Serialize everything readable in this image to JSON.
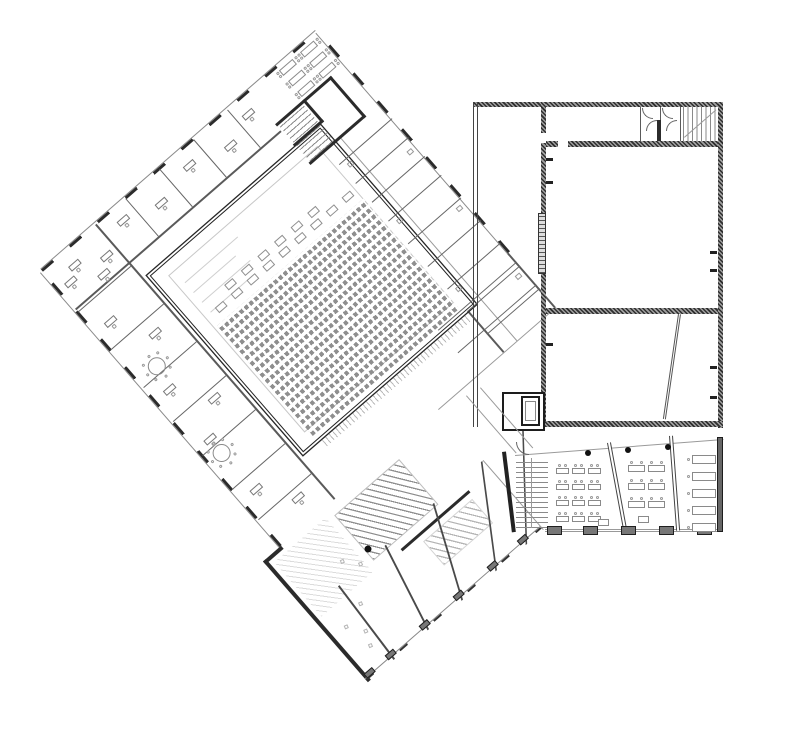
{
  "meta": {
    "drawing_kind": "architectural floor plan",
    "visible_text": ""
  },
  "palette": {
    "background": "#ffffff",
    "ink_dark": "#262626",
    "ink_mid": "#5a5a5a",
    "ink_light": "#9a9a9a",
    "ink_faint": "#cfcfcf",
    "pier_fill": "#777777",
    "hatch_dark": "#2f2f2f",
    "hatch_light": "#a0a0a0",
    "seat_gray": "#8f8f8f"
  },
  "tilted_building": {
    "rotation_deg": -41,
    "nw_partitions": [
      150,
      195,
      240,
      285
    ],
    "sw_partitions": [
      70,
      120,
      170,
      215,
      260,
      305,
      345
    ],
    "ne_partitions": [
      130,
      155,
      180,
      205,
      235,
      265,
      295,
      325,
      355
    ],
    "junction_partitions": [
      320,
      350
    ],
    "office_desks": [
      [
        62,
        30
      ],
      [
        92,
        44
      ],
      [
        128,
        28
      ],
      [
        168,
        40
      ],
      [
        214,
        30
      ],
      [
        258,
        42
      ],
      [
        292,
        30
      ],
      [
        52,
        96
      ],
      [
        78,
        134
      ],
      [
        52,
        186
      ],
      [
        80,
        222
      ],
      [
        50,
        250
      ],
      [
        52,
        318
      ],
      [
        78,
        352
      ],
      [
        48,
        40
      ],
      [
        78,
        56
      ]
    ],
    "round_tables": [
      [
        64,
        163
      ],
      [
        56,
        271
      ]
    ],
    "seminar_tables": [
      [
        350,
        20
      ],
      [
        350,
        34
      ],
      [
        350,
        48
      ],
      [
        378,
        20
      ],
      [
        378,
        34
      ],
      [
        378,
        48
      ]
    ],
    "fixtures": [
      [
        340,
        135
      ],
      [
        340,
        210
      ],
      [
        340,
        300
      ],
      [
        393,
        165
      ],
      [
        393,
        240
      ],
      [
        393,
        330
      ]
    ],
    "auditorium": {
      "seat_rows": 19,
      "seats_per_row": 30,
      "front_rows": [
        {
          "y": 157,
          "x0": 146,
          "step": 21,
          "n": 9
        },
        {
          "y": 146,
          "x0": 168,
          "step": 22,
          "n": 6
        }
      ]
    },
    "wing": {
      "partitions": [
        [
          50,
          6
        ],
        [
          95,
          22
        ],
        [
          140,
          40
        ],
        [
          185,
          58
        ],
        [
          225,
          72
        ]
      ],
      "piers": [
        18,
        46,
        91,
        136,
        181,
        221
      ],
      "scatter": [
        [
          34,
          482
        ],
        [
          46,
          498
        ],
        [
          60,
          474
        ],
        [
          40,
          512
        ],
        [
          74,
          430
        ],
        [
          86,
          444
        ]
      ]
    }
  },
  "right_building": {
    "ticks_left_wall": [
      158,
      181,
      343
    ],
    "ticks_right_wall": [
      251,
      269,
      366,
      396
    ],
    "toilet_room_x": [
      641,
      661
    ],
    "diagonal_wall": {
      "x": 678,
      "y": 314,
      "len": 106,
      "angle_deg": 8.2
    }
  },
  "classroom_wing": {
    "window_piers_x": [
      547,
      583,
      621,
      659,
      697
    ],
    "column_dots": [
      [
        585,
        450
      ],
      [
        625,
        447
      ],
      [
        665,
        444
      ]
    ],
    "room_a_desks": {
      "cols": [
        556,
        572,
        588
      ],
      "rows": [
        468,
        484,
        500,
        516
      ]
    },
    "room_b_desks": {
      "cols": [
        628,
        648
      ],
      "rows": [
        465,
        483,
        501
      ]
    },
    "room_c_desks": {
      "x": 692,
      "rows": [
        455,
        472,
        489,
        506,
        523
      ]
    },
    "teacher_desks": [
      [
        598,
        519
      ],
      [
        638,
        516
      ]
    ]
  }
}
